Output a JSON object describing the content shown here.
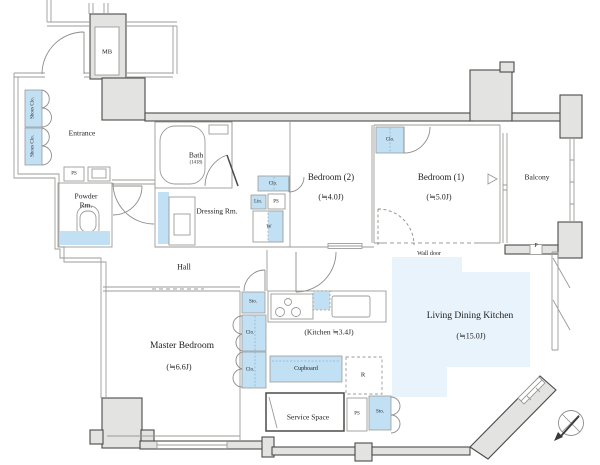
{
  "colors": {
    "wall_fill": "#e3e3e1",
    "wall_stroke": "#4b4b49",
    "line": "#9b9b99",
    "fixture_blue": "#c2e0f4",
    "floor_blue": "#e9f3fb",
    "text": "#1e1e1e"
  },
  "floor_plan": {
    "rooms": [
      {
        "id": "entrance",
        "text": "Entrance",
        "x": 82,
        "y": 133,
        "size": 7.5
      },
      {
        "id": "powder-room-line1",
        "text": "Powder",
        "x": 86,
        "y": 196,
        "size": 7.5
      },
      {
        "id": "powder-room-line2",
        "text": "Rm.",
        "x": 86,
        "y": 205,
        "size": 7.5
      },
      {
        "id": "bath",
        "text": "Bath",
        "x": 196,
        "y": 155,
        "size": 7.5
      },
      {
        "id": "dressing-room",
        "text": "Dressing Rm.",
        "x": 217,
        "y": 211,
        "size": 7.5
      },
      {
        "id": "bedroom-2",
        "text": "Bedroom (2)",
        "x": 331,
        "y": 177,
        "size": 9
      },
      {
        "id": "bedroom-2-area",
        "text": "(≒4.0J)",
        "x": 331,
        "y": 197,
        "size": 8
      },
      {
        "id": "bedroom-1",
        "text": "Bedroom (1)",
        "x": 441,
        "y": 177,
        "size": 9
      },
      {
        "id": "bedroom-1-area",
        "text": "(≒5.0J)",
        "x": 439,
        "y": 197,
        "size": 8
      },
      {
        "id": "balcony",
        "text": "Balcony",
        "x": 537,
        "y": 177,
        "size": 7.5
      },
      {
        "id": "hall",
        "text": "Hall",
        "x": 184,
        "y": 267,
        "size": 8
      },
      {
        "id": "master-bedroom",
        "text": "Master Bedroom",
        "x": 182,
        "y": 346,
        "size": 9.5
      },
      {
        "id": "master-bedroom-area",
        "text": "(≒6.6J)",
        "x": 179,
        "y": 367,
        "size": 8
      },
      {
        "id": "kitchen",
        "text": "(Kitchen ≒3.4J)",
        "x": 329,
        "y": 332,
        "size": 7.5
      },
      {
        "id": "ldk",
        "text": "Living Dining Kitchen",
        "x": 470,
        "y": 316,
        "size": 9.5
      },
      {
        "id": "ldk-area",
        "text": "(≒15.0J)",
        "x": 471,
        "y": 336,
        "size": 8
      },
      {
        "id": "service-space",
        "text": "Service Space",
        "x": 308,
        "y": 417,
        "size": 7.5
      },
      {
        "id": "meter-box",
        "text": "MB",
        "x": 107,
        "y": 52,
        "size": 6.5
      }
    ],
    "fixtures": [
      {
        "id": "shoes-closet-1",
        "text": "Shoes Clo.",
        "x": 33,
        "y": 108,
        "size": 5,
        "rot": -90
      },
      {
        "id": "shoes-closet-2",
        "text": "Shoes Clo.",
        "x": 33,
        "y": 146,
        "size": 5,
        "rot": -90
      },
      {
        "id": "ps-powder",
        "text": "PS",
        "x": 74,
        "y": 174,
        "size": 5
      },
      {
        "id": "closet-dressing",
        "text": "Clo.",
        "x": 273,
        "y": 184,
        "size": 5
      },
      {
        "id": "linen",
        "text": "Lin.",
        "x": 258,
        "y": 202,
        "size": 4.8
      },
      {
        "id": "ps-dressing",
        "text": "PS",
        "x": 276,
        "y": 202,
        "size": 5
      },
      {
        "id": "washer",
        "text": "W",
        "x": 269,
        "y": 227,
        "size": 5.5
      },
      {
        "id": "closet-bedroom-1",
        "text": "Clo.",
        "x": 390,
        "y": 140,
        "size": 5
      },
      {
        "id": "storage-kitchen",
        "text": "Sto.",
        "x": 253,
        "y": 302,
        "size": 5
      },
      {
        "id": "closet-master-1",
        "text": "Clo.",
        "x": 250,
        "y": 333,
        "size": 5
      },
      {
        "id": "closet-master-2",
        "text": "Clo.",
        "x": 250,
        "y": 370,
        "size": 5
      },
      {
        "id": "cupboard",
        "text": "Cupboard",
        "x": 306,
        "y": 369,
        "size": 6
      },
      {
        "id": "refrigerator",
        "text": "R",
        "x": 363,
        "y": 375,
        "size": 6.5
      },
      {
        "id": "ps-service",
        "text": "PS",
        "x": 357,
        "y": 414,
        "size": 5
      },
      {
        "id": "storage-service",
        "text": "Sto.",
        "x": 380,
        "y": 412,
        "size": 5
      }
    ],
    "annotations": [
      {
        "id": "bath-size",
        "text": "(1418)",
        "x": 196,
        "y": 163,
        "size": 4.8
      },
      {
        "id": "wall-door",
        "text": "Wall door",
        "x": 429,
        "y": 254,
        "size": 6
      },
      {
        "id": "balcony-partition",
        "text": "P",
        "x": 536,
        "y": 246,
        "size": 6
      }
    ],
    "icons": [
      {
        "id": "compass",
        "name": "north-arrow-compass-icon"
      },
      {
        "id": "opening-triangle",
        "name": "opening-direction-triangle-icon"
      }
    ]
  }
}
